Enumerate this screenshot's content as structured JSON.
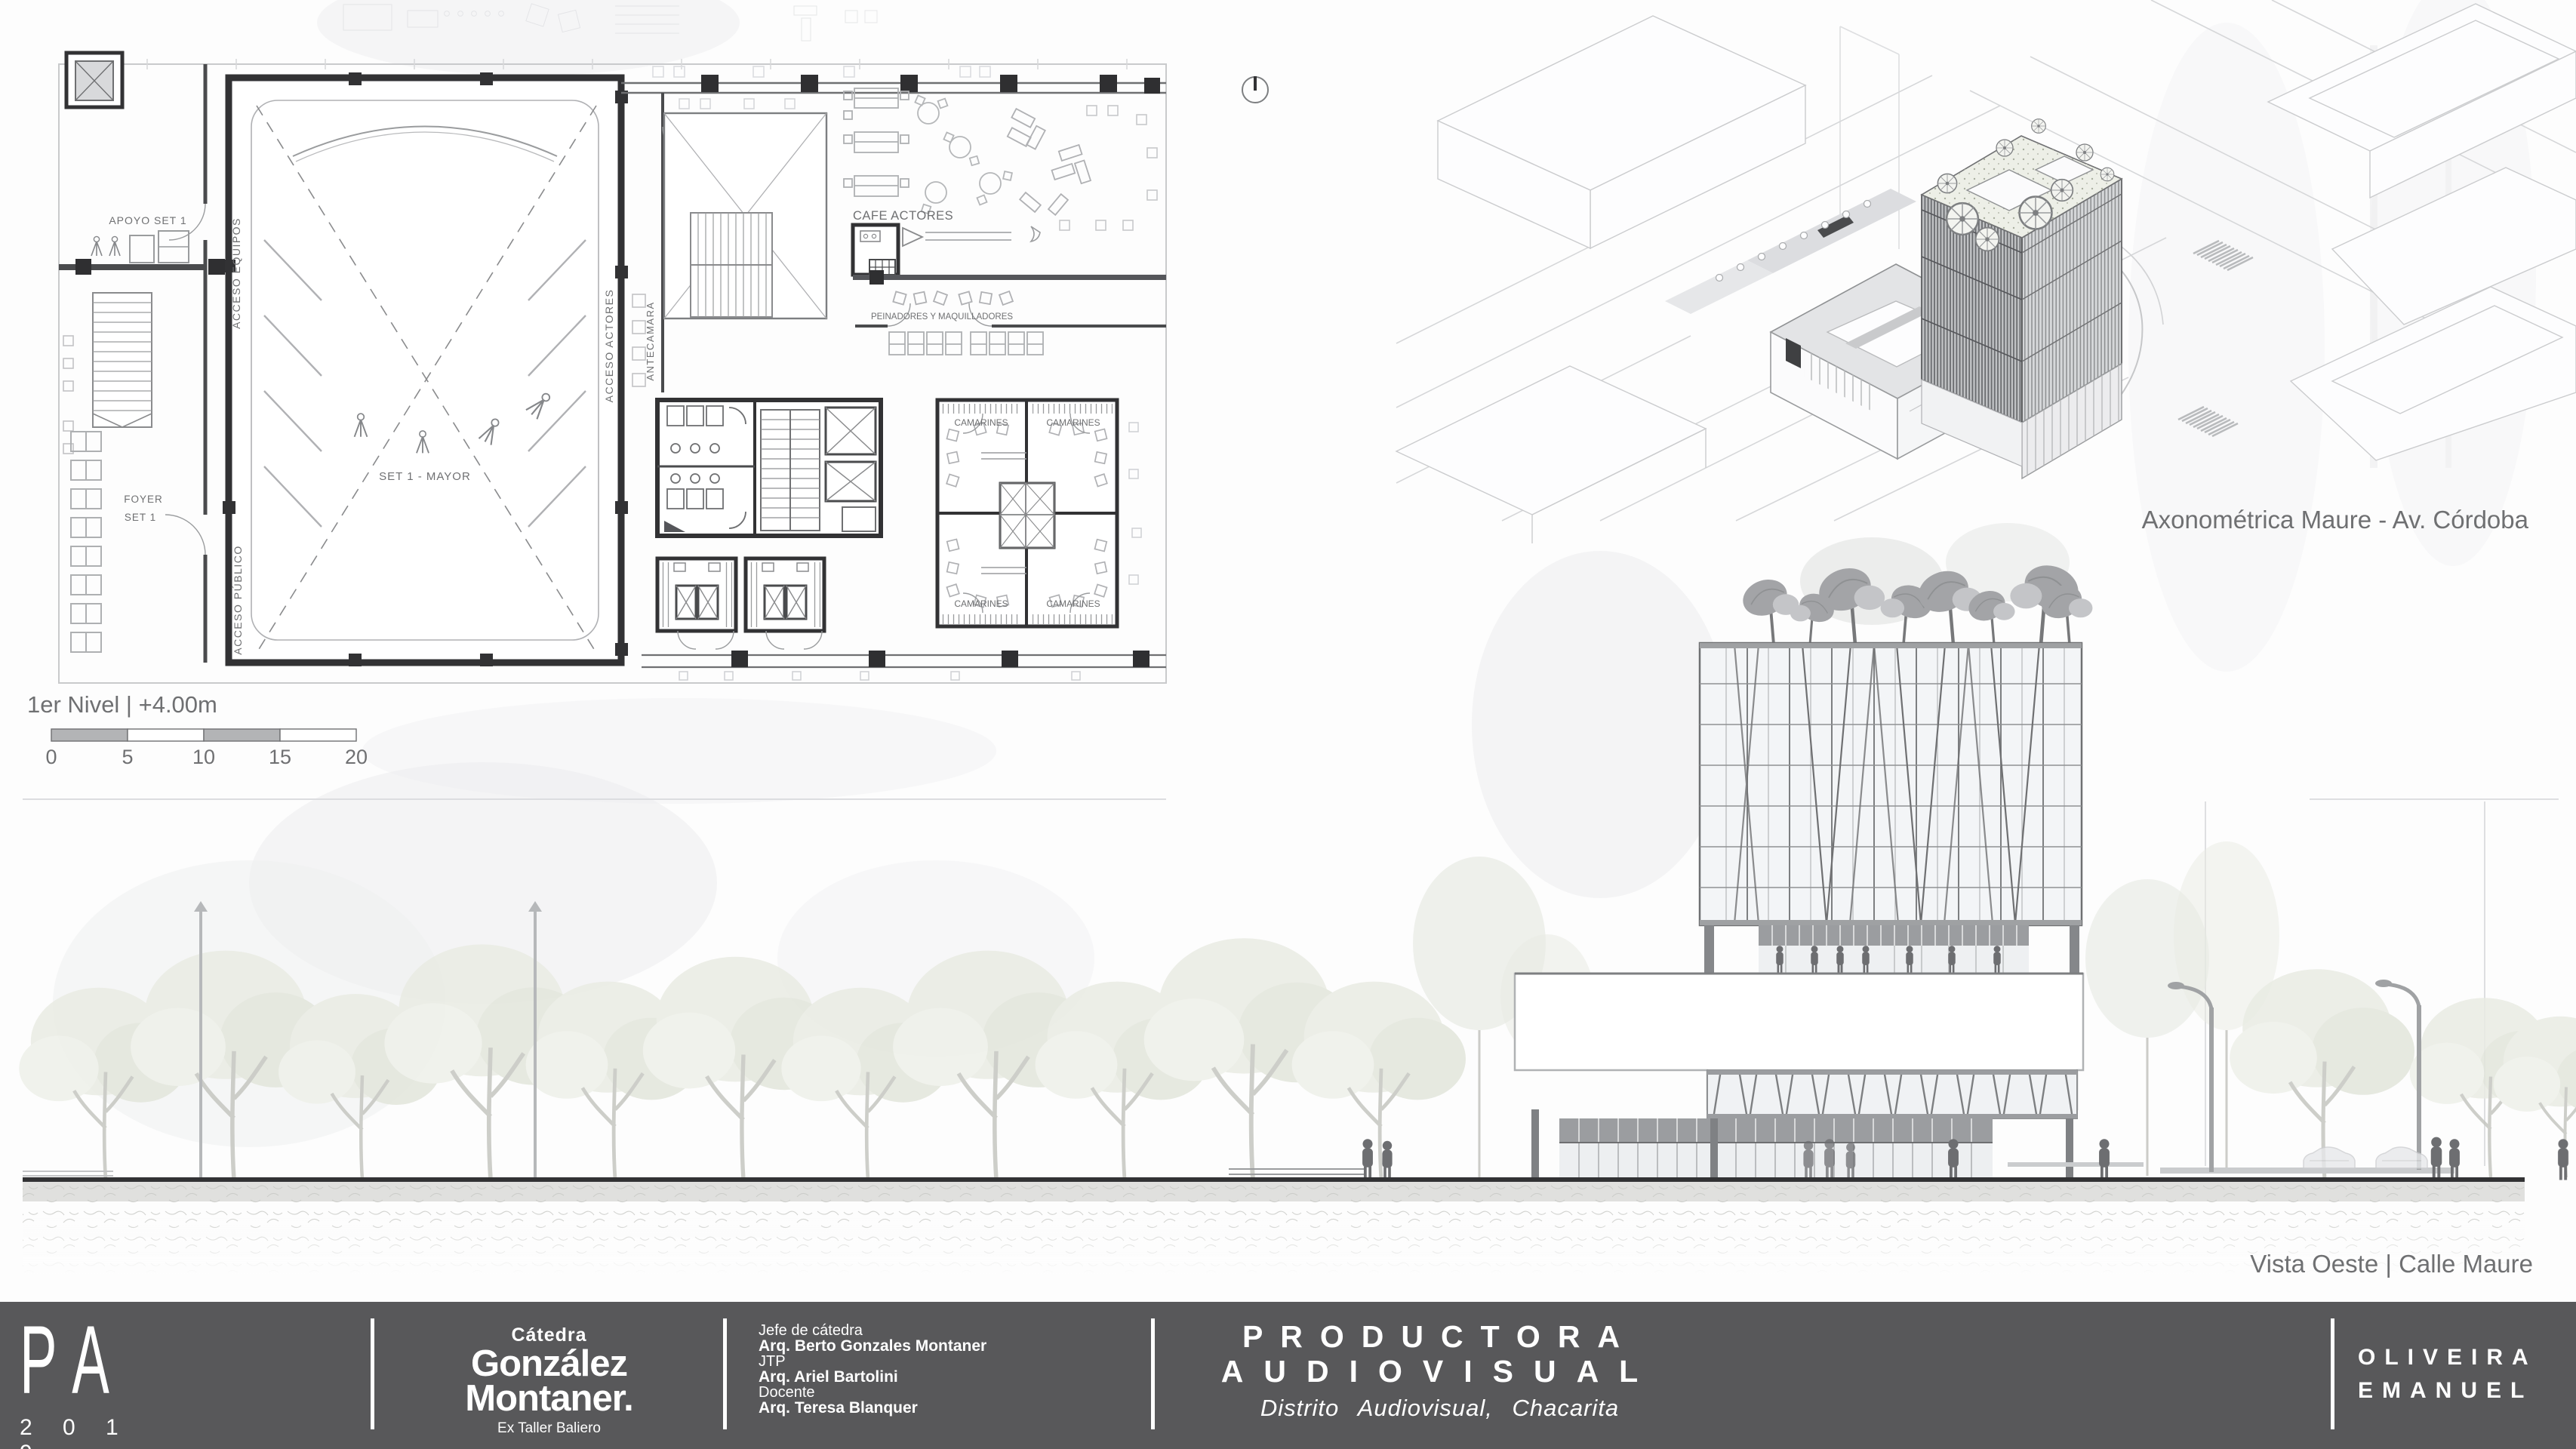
{
  "colors": {
    "footer_bg": "#58585a",
    "paper": "#fdfdfd",
    "line_dark": "#323234"
  },
  "board": {
    "plan": {
      "title": "1er Nivel | +4.00m",
      "scale_ticks": [
        "0",
        "5",
        "10",
        "15",
        "20"
      ],
      "labels": {
        "apoyo": "APOYO SET 1",
        "acceso_equipos": "ACCESO EQUIPOS",
        "acceso_publico": "ACCESO PÚBLICO",
        "foyer_line1": "FOYER",
        "foyer_line2": "SET 1",
        "set_mayor": "SET 1 - MAYOR",
        "acceso_actores": "ACCESO ACTORES",
        "antecamara": "ANTECAMARA",
        "cafe": "CAFE ACTORES",
        "peinadores": "PEINADORES Y MAQUILLADORES",
        "camarines": "CAMARINES"
      }
    },
    "axonometric": {
      "caption": "Axonométrica  Maure - Av. Córdoba"
    },
    "elevation": {
      "caption": "Vista Oeste | Calle Maure"
    },
    "footer": {
      "logo": {
        "letter_p": "P",
        "letter_a": "A",
        "year": "2 0 1 9"
      },
      "catedra": {
        "label": "Cátedra",
        "name_line1": "González",
        "name_line2": "Montaner.",
        "sub": "Ex Taller Baliero"
      },
      "staff": [
        {
          "role": "Jefe de cátedra",
          "name": "Arq. Berto Gonzales Montaner"
        },
        {
          "role": "JTP",
          "name": "Arq. Ariel Bartolini"
        },
        {
          "role": "Docente",
          "name": "Arq. Teresa Blanquer"
        }
      ],
      "project": {
        "line1": "PRODUCTORA",
        "line2": "AUDIOVISUAL",
        "subtitle": "Distrito Audiovisual, Chacarita"
      },
      "student": {
        "line1": "OLIVEIRA",
        "line2": "EMANUEL"
      }
    }
  }
}
